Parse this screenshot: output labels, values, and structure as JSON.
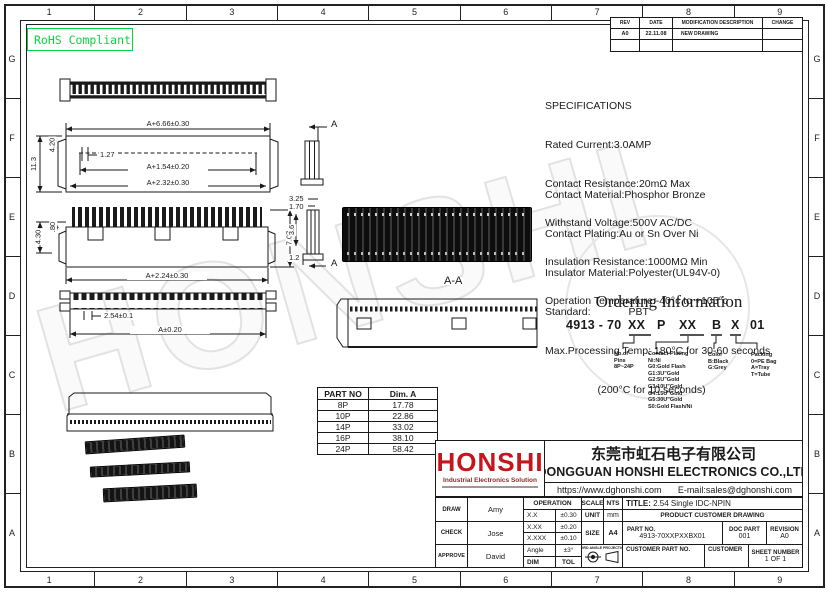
{
  "frame": {
    "cols": [
      "1",
      "2",
      "3",
      "4",
      "5",
      "6",
      "7",
      "8",
      "9"
    ],
    "rows": [
      "G",
      "F",
      "E",
      "D",
      "C",
      "B",
      "A"
    ],
    "rohs_label": "RoHS Compliant",
    "rohs_color": "#0ad43c"
  },
  "revision_table": {
    "headers": [
      "REV",
      "DATE",
      "MODIFICATION DESCRIPTION",
      "CHANGE"
    ],
    "row": {
      "rev": "A0",
      "date": "22.11.08",
      "desc": "NEW DRAWING",
      "change": ""
    }
  },
  "specs": {
    "title": "SPECIFICATIONS",
    "lines1": [
      "Rated Current:3.0AMP",
      "Contact Resistance:20mΩ Max",
      "Withstand Voltage:500V AC/DC",
      "Insulation Resistance:1000MΩ Min",
      "Operation Temperature:-40°c to +105°c"
    ],
    "lines2": [
      "Contact Material:Phosphor Bronze",
      "Contact Plating:Au or Sn Over Ni",
      "Insulator Material:Polyester(UL94V-0)",
      "Standard:             PBT",
      "Max.Processing Temp: 180°C for 30-60 seconds",
      "                  (200°C for 10 seconds)"
    ]
  },
  "labels": {
    "dim_a666": "A+6.66±0.30",
    "dim_113": "11.3",
    "dim_420": "4.20",
    "dim_127": "1.27",
    "dim_a154": "A+1.54±0.20",
    "dim_a232": "A+2.32±0.30",
    "dim_080": ".80",
    "dim_430": "4.30",
    "dim_707": "7.07",
    "dim_a224": "A+2.24±0.30",
    "dim_325": "3.25",
    "dim_170": "1.70",
    "dim_36": "3.6",
    "dim_12": "1.2",
    "section_a_top": "A",
    "section_a_bottom": "A",
    "section_aa": "A-A",
    "dim_254": "2.54±0.1",
    "dim_a020": "A±0.20"
  },
  "ordering": {
    "title": "Ordering Information",
    "code": {
      "base": "4913 - 70",
      "pins": "XX",
      "p": "P",
      "plating": "XX",
      "color": "B",
      "packing": "X",
      "suffix": "01"
    },
    "legend_pins": [
      "No.of",
      "Pins",
      "8P~24P"
    ],
    "legend_plating": [
      "Contact Plating",
      "Ni:Ni",
      "G0:Gold Flash",
      "G1:3U\"Gold",
      "G2:5U\"Gold",
      "G3:10U\"Gold",
      "G4:15U\"Gold",
      "G5:30U\"Gold",
      "S0:Gold Flash/Ni"
    ],
    "legend_color": [
      "Color",
      "B:Black",
      "G:Grey"
    ],
    "legend_packing": [
      "Packing",
      "0=PE Bag",
      "A=Tray",
      "T=Tube"
    ]
  },
  "part_table": {
    "headers": [
      "PART NO",
      "Dim. A"
    ],
    "rows": [
      [
        "8P",
        "17.78"
      ],
      [
        "10P",
        "22.86"
      ],
      [
        "14P",
        "33.02"
      ],
      [
        "16P",
        "38.10"
      ],
      [
        "24P",
        "58.42"
      ]
    ]
  },
  "title_block": {
    "logo": "HONSHI",
    "logo_tagline": "Industrial Electronics Solution",
    "logo_color": "#c4161c",
    "company_cn": "东莞市虹石电子有限公司",
    "company_en": "DONGGUAN HONSHI ELECTRONICS CO.,LTD",
    "website": "https://www.dghonshi.com",
    "email": "E-mail:sales@dghonshi.com",
    "draw_label": "DRAW",
    "draw_name": "Amy",
    "check_label": "CHECK",
    "check_name": "Jose",
    "approve_label": "APPROVE",
    "approve_name": "David",
    "operation_label": "OPERATION",
    "tol_rows": [
      [
        "X.X",
        "±0.30"
      ],
      [
        "X.XX",
        "±0.20"
      ],
      [
        "X.XXX",
        "±0.10"
      ],
      [
        "Angle",
        "±3°"
      ],
      [
        "DIM",
        "TOL"
      ]
    ],
    "scale_label": "SCALE",
    "scale_value": "NTS",
    "unit_label": "UNIT",
    "unit_value": "mm",
    "size_label": "SIZE",
    "size_value": "A4",
    "projection_label": "THIRD ANGLE PROJECTION",
    "title_label": "TITLE:",
    "title_value": "2.54 Single IDC-NPIN",
    "product_row": "PRODUCT CUSTOMER DRAWING",
    "part_no_label": "PART NO.",
    "part_no_value": "4913-70XXPXXBX01",
    "doc_part_label": "DOC PART",
    "doc_part_value": "001",
    "revision_label": "REVISION",
    "revision_value": "A0",
    "customer_part_label": "CUSTOMER PART NO.",
    "customer_label": "CUSTOMER",
    "sheet_label": "SHEET NUMBER",
    "sheet_value": "1 OF 1"
  },
  "watermark": "HONSHI"
}
